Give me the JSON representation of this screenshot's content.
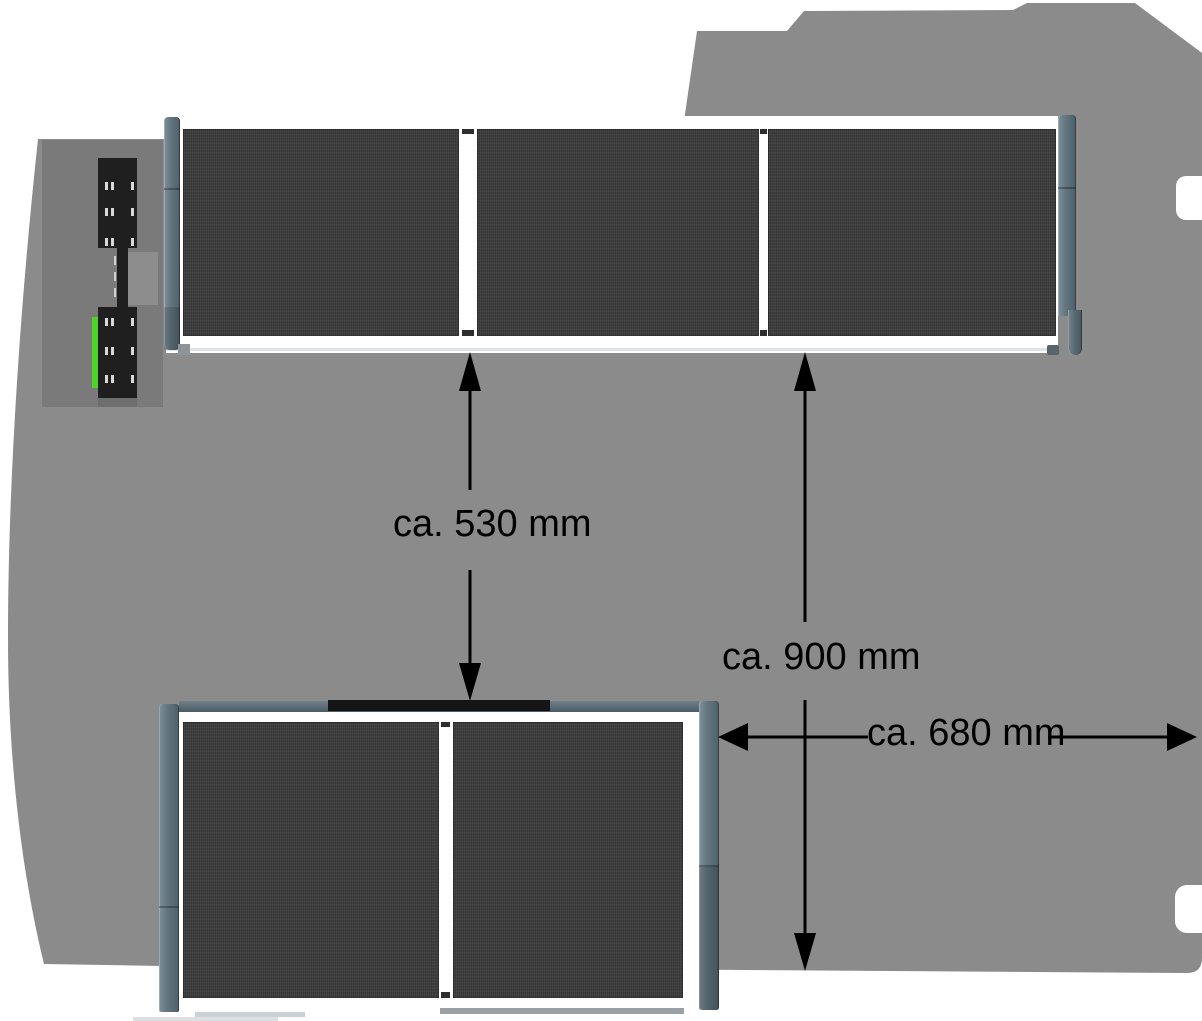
{
  "diagram": {
    "title": "Van cargo area top view with shelf modules and clearance dimensions",
    "dimension_labels": [
      {
        "id": "dim-530",
        "text": "ca. 530 mm"
      },
      {
        "id": "dim-900",
        "text": "ca. 900 mm"
      },
      {
        "id": "dim-680",
        "text": "ca. 680 mm"
      }
    ],
    "components": {
      "top_shelf_unit": {
        "name": "top shelf unit",
        "panel_count": 3
      },
      "bottom_shelf_unit": {
        "name": "bottom shelf unit",
        "panel_count": 2
      },
      "wall_bracket": {
        "name": "wall mounting bracket with green strip"
      }
    },
    "colors": {
      "background": "#ffffff",
      "van_floor": "#8b8b8b",
      "bracket_backdrop": "#7a7a7a",
      "panel_dark": "#3f3f3f",
      "post_blue_gray": "#5d707a",
      "frame_white": "#ffffff",
      "accent_green": "#4fd32a",
      "arrow_black": "#000000"
    }
  }
}
